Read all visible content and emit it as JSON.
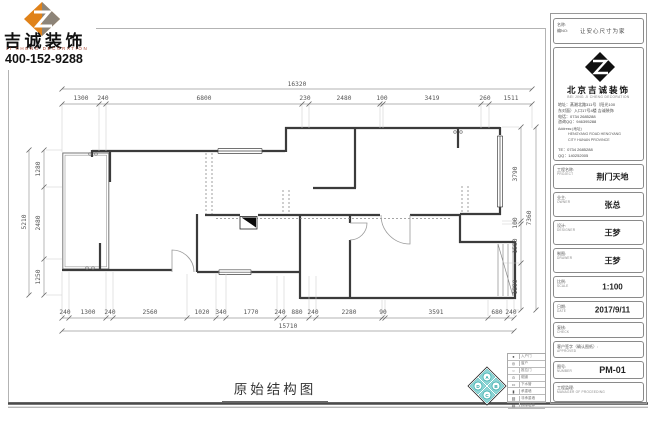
{
  "logo": {
    "company_cn": "吉诚装饰",
    "company_en": "JI CHENG DECORATION",
    "phone": "400-152-9288"
  },
  "drawing": {
    "title": "原始结构图"
  },
  "dims": {
    "top": {
      "total": "16320",
      "segments": [
        "1300",
        "240",
        "6800",
        "230",
        "2480",
        "100",
        "3419",
        "260",
        "1511"
      ]
    },
    "bottom": {
      "total": "15710",
      "segments": [
        "240",
        "1300",
        "240",
        "2560",
        "1020",
        "340",
        "1770",
        "240",
        "880",
        "240",
        "2280",
        "90",
        "3591",
        "680",
        "240"
      ]
    },
    "left": {
      "total": "5210",
      "segments": [
        "1280",
        "2480",
        "1250"
      ]
    },
    "right": {
      "total": "7360",
      "segments": [
        "3790",
        "100",
        "1580",
        "1890"
      ]
    }
  },
  "compass": {
    "letters": [
      "A",
      "B",
      "C",
      "D"
    ]
  },
  "legend": {
    "rows": [
      {
        "symbol": "●",
        "label": "入户门"
      },
      {
        "symbol": "◎",
        "label": "窗户"
      },
      {
        "symbol": "○",
        "label": "推拉门"
      },
      {
        "symbol": "⊙",
        "label": "烟道"
      },
      {
        "symbol": "▭",
        "label": "下水管"
      },
      {
        "symbol": "▮",
        "label": "承重墙"
      },
      {
        "symbol": "▨",
        "label": "非承重墙"
      },
      {
        "symbol": "▤",
        "label": "拆除墙体"
      }
    ]
  },
  "title_block": {
    "name_label": "名称:",
    "no_label": "编NO:",
    "slogan": "让安心尺寸为家",
    "company_cn": "北京吉诚装饰",
    "company_en": "BEI JING JI CHENG DECORATION",
    "address_lines": [
      "地址：蒸湘北路311号（阳光100",
      "东对面）入口17号4楼 吉诚装饰",
      "电话：0734 2685288",
      "咨询QQ：946395288"
    ],
    "address_en_label": "Address:(地址)",
    "address_en_lines": [
      "HENGYANG ROAD HENGYANG",
      "CITY HUNAN PROVINCE"
    ],
    "tel_line": "TE：0734 2685288",
    "qq_line": "QQ：140252005",
    "fields": [
      {
        "label_cn": "工程名称:",
        "label_en": "PROJECT",
        "value": "荆门天地"
      },
      {
        "label_cn": "业主:",
        "label_en": "OWNER",
        "value": "张总"
      },
      {
        "label_cn": "设计:",
        "label_en": "DESIGNER",
        "value": "王梦"
      },
      {
        "label_cn": "制图:",
        "label_en": "DRAWER",
        "value": "王梦"
      },
      {
        "label_cn": "比例:",
        "label_en": "SCALE",
        "value": "1:100"
      },
      {
        "label_cn": "日期:",
        "label_en": "DATE",
        "value": "2017/9/11"
      },
      {
        "label_cn": "复核:",
        "label_en": "CHECK",
        "value": ""
      },
      {
        "label_cn": "客户签字（确认图纸）:",
        "label_en": "APPROVED",
        "value": ""
      },
      {
        "label_cn": "图号:",
        "label_en": "NUMBER",
        "value": "PM-01"
      },
      {
        "label_cn": "工程监理:",
        "label_en": "MANAGER OF PROCEEDING",
        "value": ""
      }
    ]
  }
}
